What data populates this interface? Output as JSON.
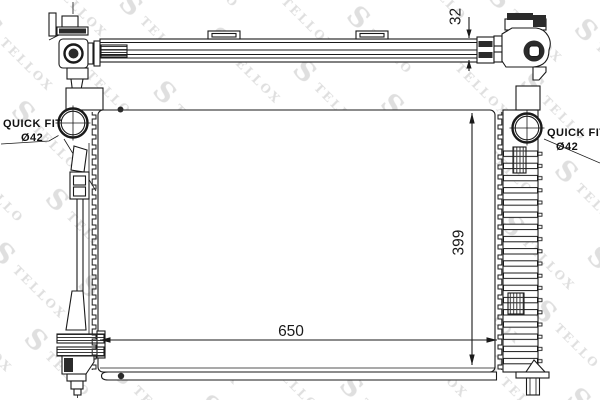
{
  "watermark": {
    "initial": "S",
    "word_rest": "TELLOX"
  },
  "dimensions": {
    "core_width": "650",
    "core_height": "399",
    "top_depth": "32"
  },
  "quick_fit_left": {
    "title": "QUICK FIT",
    "diameter": "Ø42"
  },
  "quick_fit_right": {
    "title": "QUICK FIT",
    "diameter": "Ø42"
  },
  "colors": {
    "line": "#1a1a1a",
    "watermark": "#dfdfdf",
    "background": "#ffffff"
  }
}
